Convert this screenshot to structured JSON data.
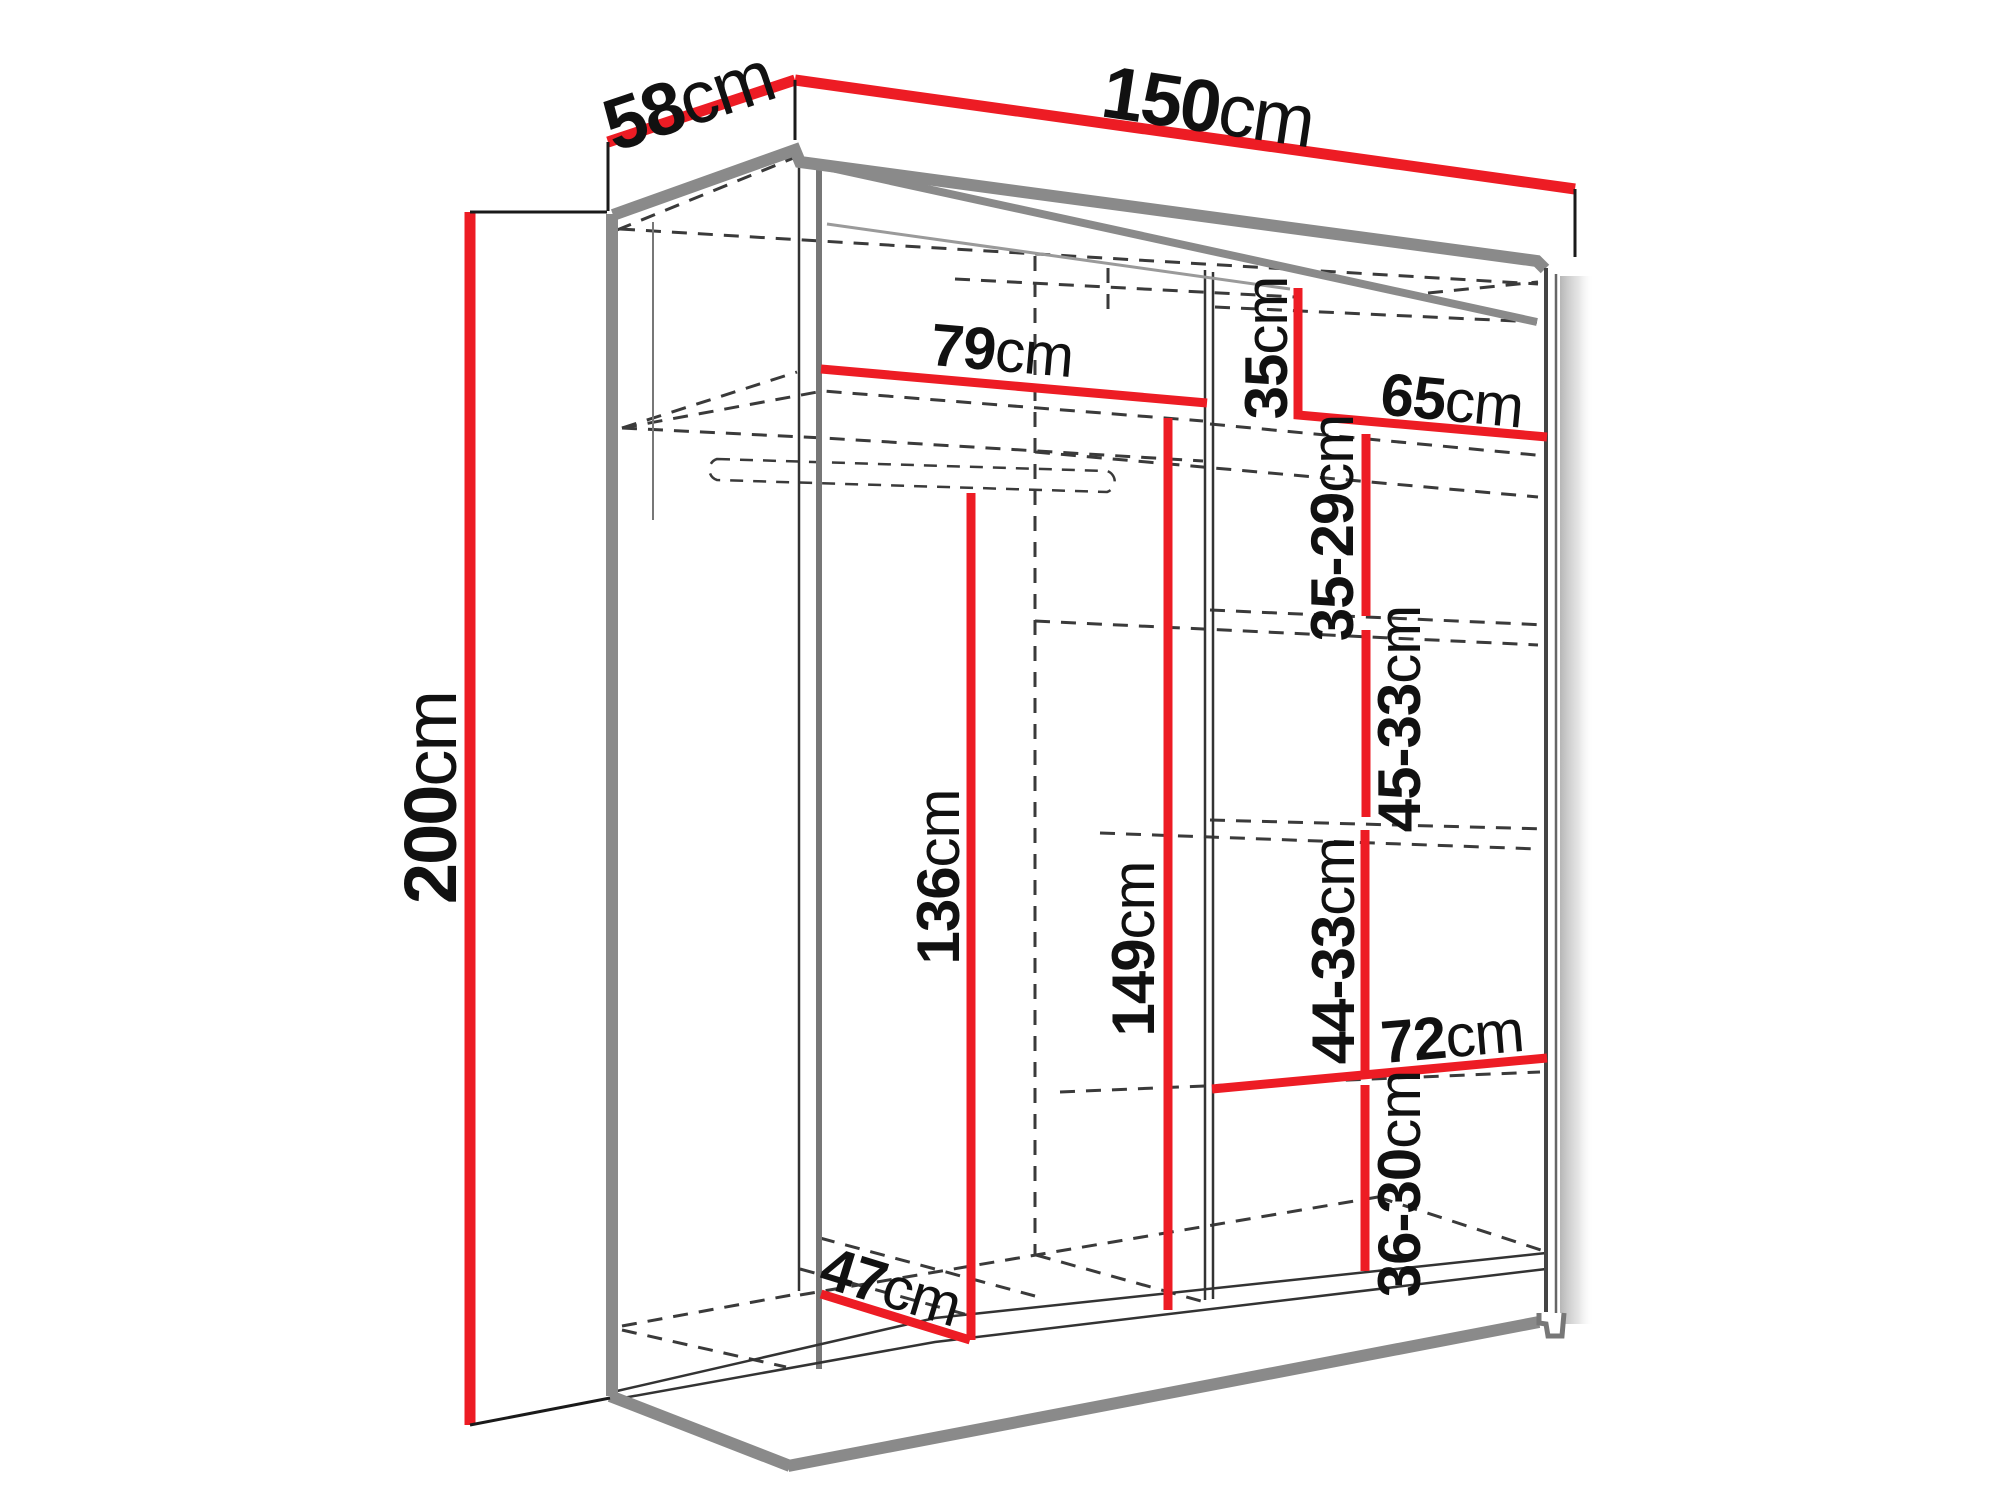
{
  "diagram": {
    "type": "furniture-dimension-diagram",
    "subject": "two-door sliding wardrobe with interior shelves and hanging rail",
    "unit": "cm",
    "colors": {
      "dimension_line": "#ed1c24",
      "outline_gray": "#8a8a8a",
      "edge_black": "#1a1a1a",
      "hidden_edge": "#3a3a3a",
      "background": "#ffffff"
    },
    "dimensions": {
      "depth_top": {
        "value": "58",
        "unit": "cm"
      },
      "width_top": {
        "value": "150",
        "unit": "cm"
      },
      "height_left": {
        "value": "200",
        "unit": "cm"
      },
      "left_top_shelf_width": {
        "value": "79",
        "unit": "cm"
      },
      "right_top_cubby_height": {
        "value": "35",
        "unit": "cm"
      },
      "right_section_width_top": {
        "value": "65",
        "unit": "cm"
      },
      "right_shelf_gap_1": {
        "value": "35-29",
        "unit": "cm"
      },
      "right_shelf_gap_2": {
        "value": "45-33",
        "unit": "cm"
      },
      "left_interior_height": {
        "value": "136",
        "unit": "cm"
      },
      "middle_interior_height": {
        "value": "149",
        "unit": "cm"
      },
      "right_shelf_gap_3": {
        "value": "44-33",
        "unit": "cm"
      },
      "right_section_width_bottom": {
        "value": "72",
        "unit": "cm"
      },
      "right_shelf_gap_4": {
        "value": "36-30",
        "unit": "cm"
      },
      "interior_depth_bottom": {
        "value": "47",
        "unit": "cm"
      }
    }
  }
}
